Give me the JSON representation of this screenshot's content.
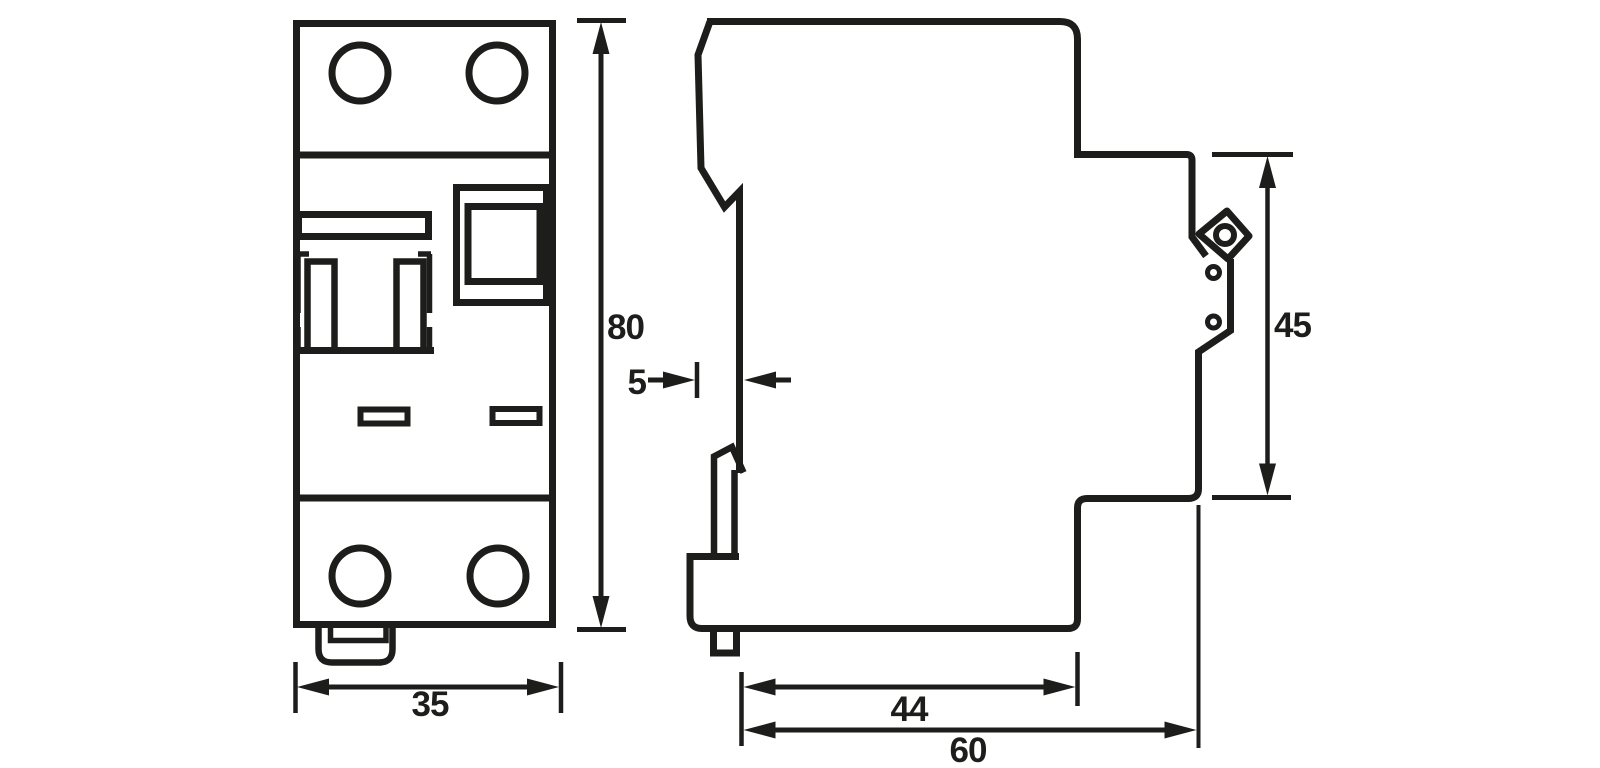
{
  "drawing": {
    "background": "#ffffff",
    "line_color": "#1d1d1b",
    "labels": {
      "height": "80",
      "width": "35",
      "rail_offset": "5",
      "front_height": "45",
      "body_depth": "44",
      "total_depth": "60"
    }
  }
}
